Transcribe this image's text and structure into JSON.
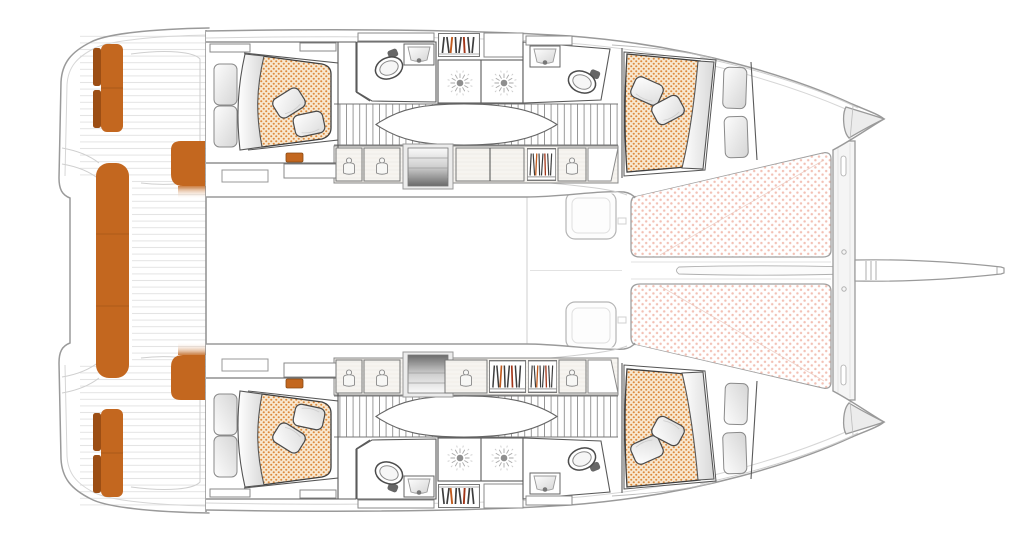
{
  "plan": {
    "type": "yacht-floor-plan",
    "view": "overhead-deck-plan",
    "vessel_type": "sailing-catamaran",
    "hulls": [
      {
        "name": "port-hull",
        "cabins": 2,
        "bathrooms": 2,
        "toilets": 2,
        "sinks": 2,
        "shower_heads": 2,
        "wardrobes": 3,
        "bookshelves": 2,
        "staircase": 1,
        "companionway_steps": 1,
        "beds": 2
      },
      {
        "name": "starboard-hull",
        "cabins": 2,
        "bathrooms": 2,
        "toilets": 2,
        "sinks": 2,
        "shower_heads": 2,
        "wardrobes": 4,
        "bookshelves": 3,
        "staircase": 1,
        "companionway_steps": 1,
        "beds": 2
      }
    ],
    "beds_total": 4,
    "pillows_total": 8,
    "cockpit": {
      "transom_benches": 2,
      "main_bench_seats": 3,
      "corner_seats": 2
    },
    "foredeck": {
      "trampoline_panels": 2,
      "deck_hatches": 2,
      "crossbeam": 1,
      "bowsprit": 1
    }
  },
  "palette": {
    "background": "#ffffff",
    "upholstery_orange": "#c3671f",
    "upholstery_orange_dark": "#9c4e14",
    "bed_fabric": "#f8e8d0",
    "bed_dot": "#dd8a3e",
    "trampoline_dot": "#edab9a",
    "wall_dark": "#4a4a4a",
    "hull_outline": "#9a9a9a",
    "book_accent_red": "#a23417",
    "book_accent_orange": "#c05a1d",
    "step_shadow": "#6b6b6b"
  }
}
